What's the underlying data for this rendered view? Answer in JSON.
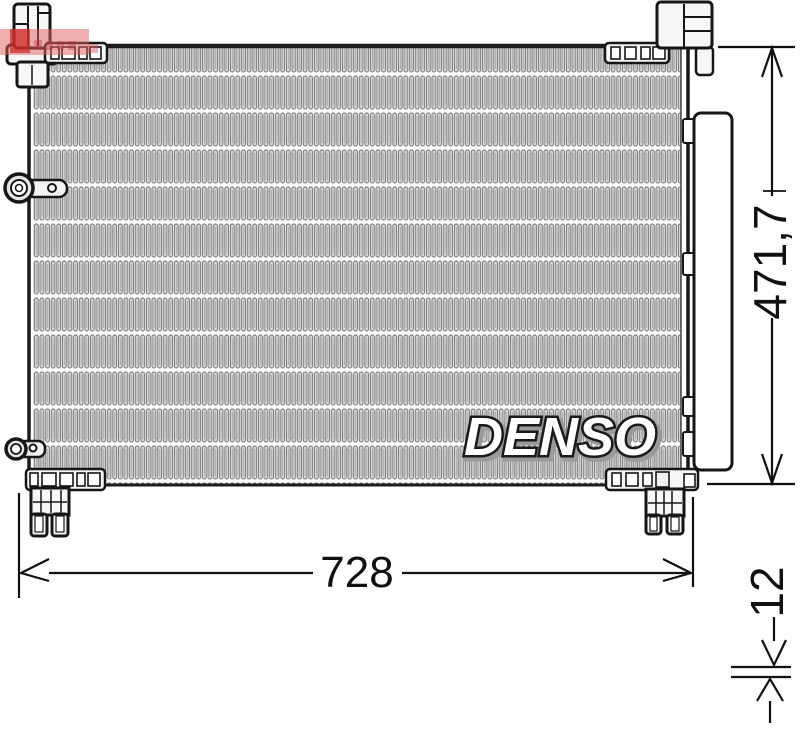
{
  "drawing": {
    "brand_logo": "DENSO",
    "dimensions": {
      "width": "728",
      "height": "471,7",
      "depth": "12"
    }
  },
  "colors": {
    "line": "#161616",
    "dimension_line": "#111111",
    "fin_fill": "#d8d8d8",
    "fin_outline": "#6a6a6a",
    "part_fill": "#f7f7f7",
    "watermark_red": "#dd5f5f"
  }
}
